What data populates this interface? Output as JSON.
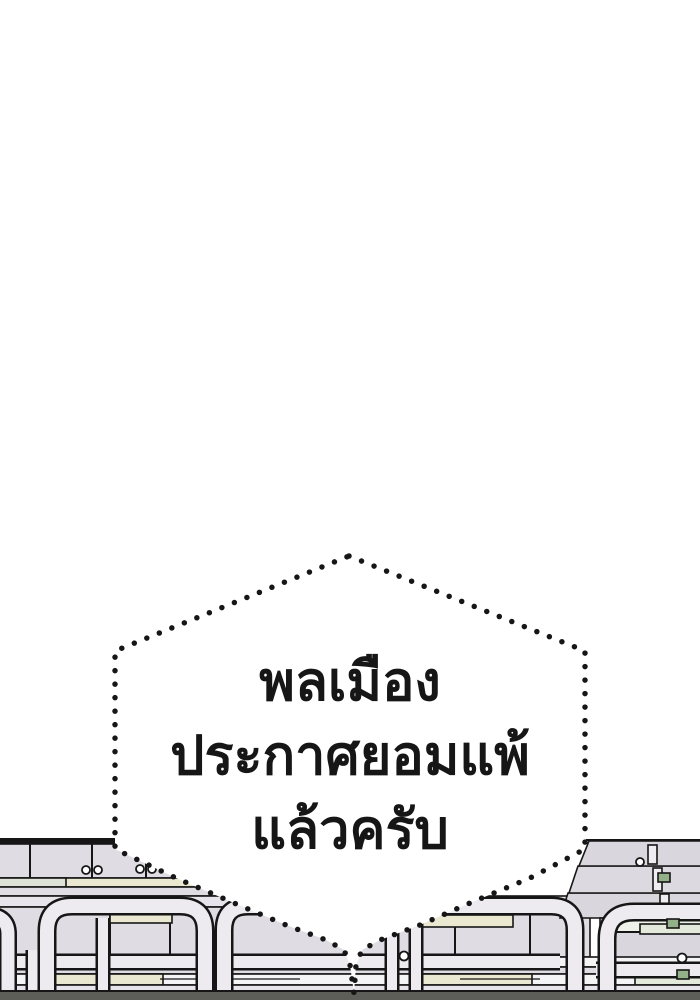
{
  "panel": {
    "type": "webtoon-comic-panel",
    "background": "#ffffff"
  },
  "speech_bubble": {
    "shape": "dotted-hexagon-with-tapering-tail",
    "fill": "#ffffff",
    "dot_color": "#161616",
    "text_color": "#161616",
    "lines": [
      "พลเมือง",
      "ประกาศยอมแพ้",
      "แล้วครับ"
    ]
  },
  "scene": {
    "description": "empty stadium bleacher rows with white tubular guard railings seen from the side; dark ground strip along the bottom edge",
    "colors": {
      "outline": "#161616",
      "bleacher_panel": "#dfdce4",
      "bleacher_panel_shaded": "#d9d6de",
      "bench_slat_yellow": "#eae8d0",
      "bench_slat_green": "#dde3d6",
      "railing_tube": "#edebf0",
      "clamp_green": "#93b188",
      "ground": "#5e5e58"
    }
  }
}
